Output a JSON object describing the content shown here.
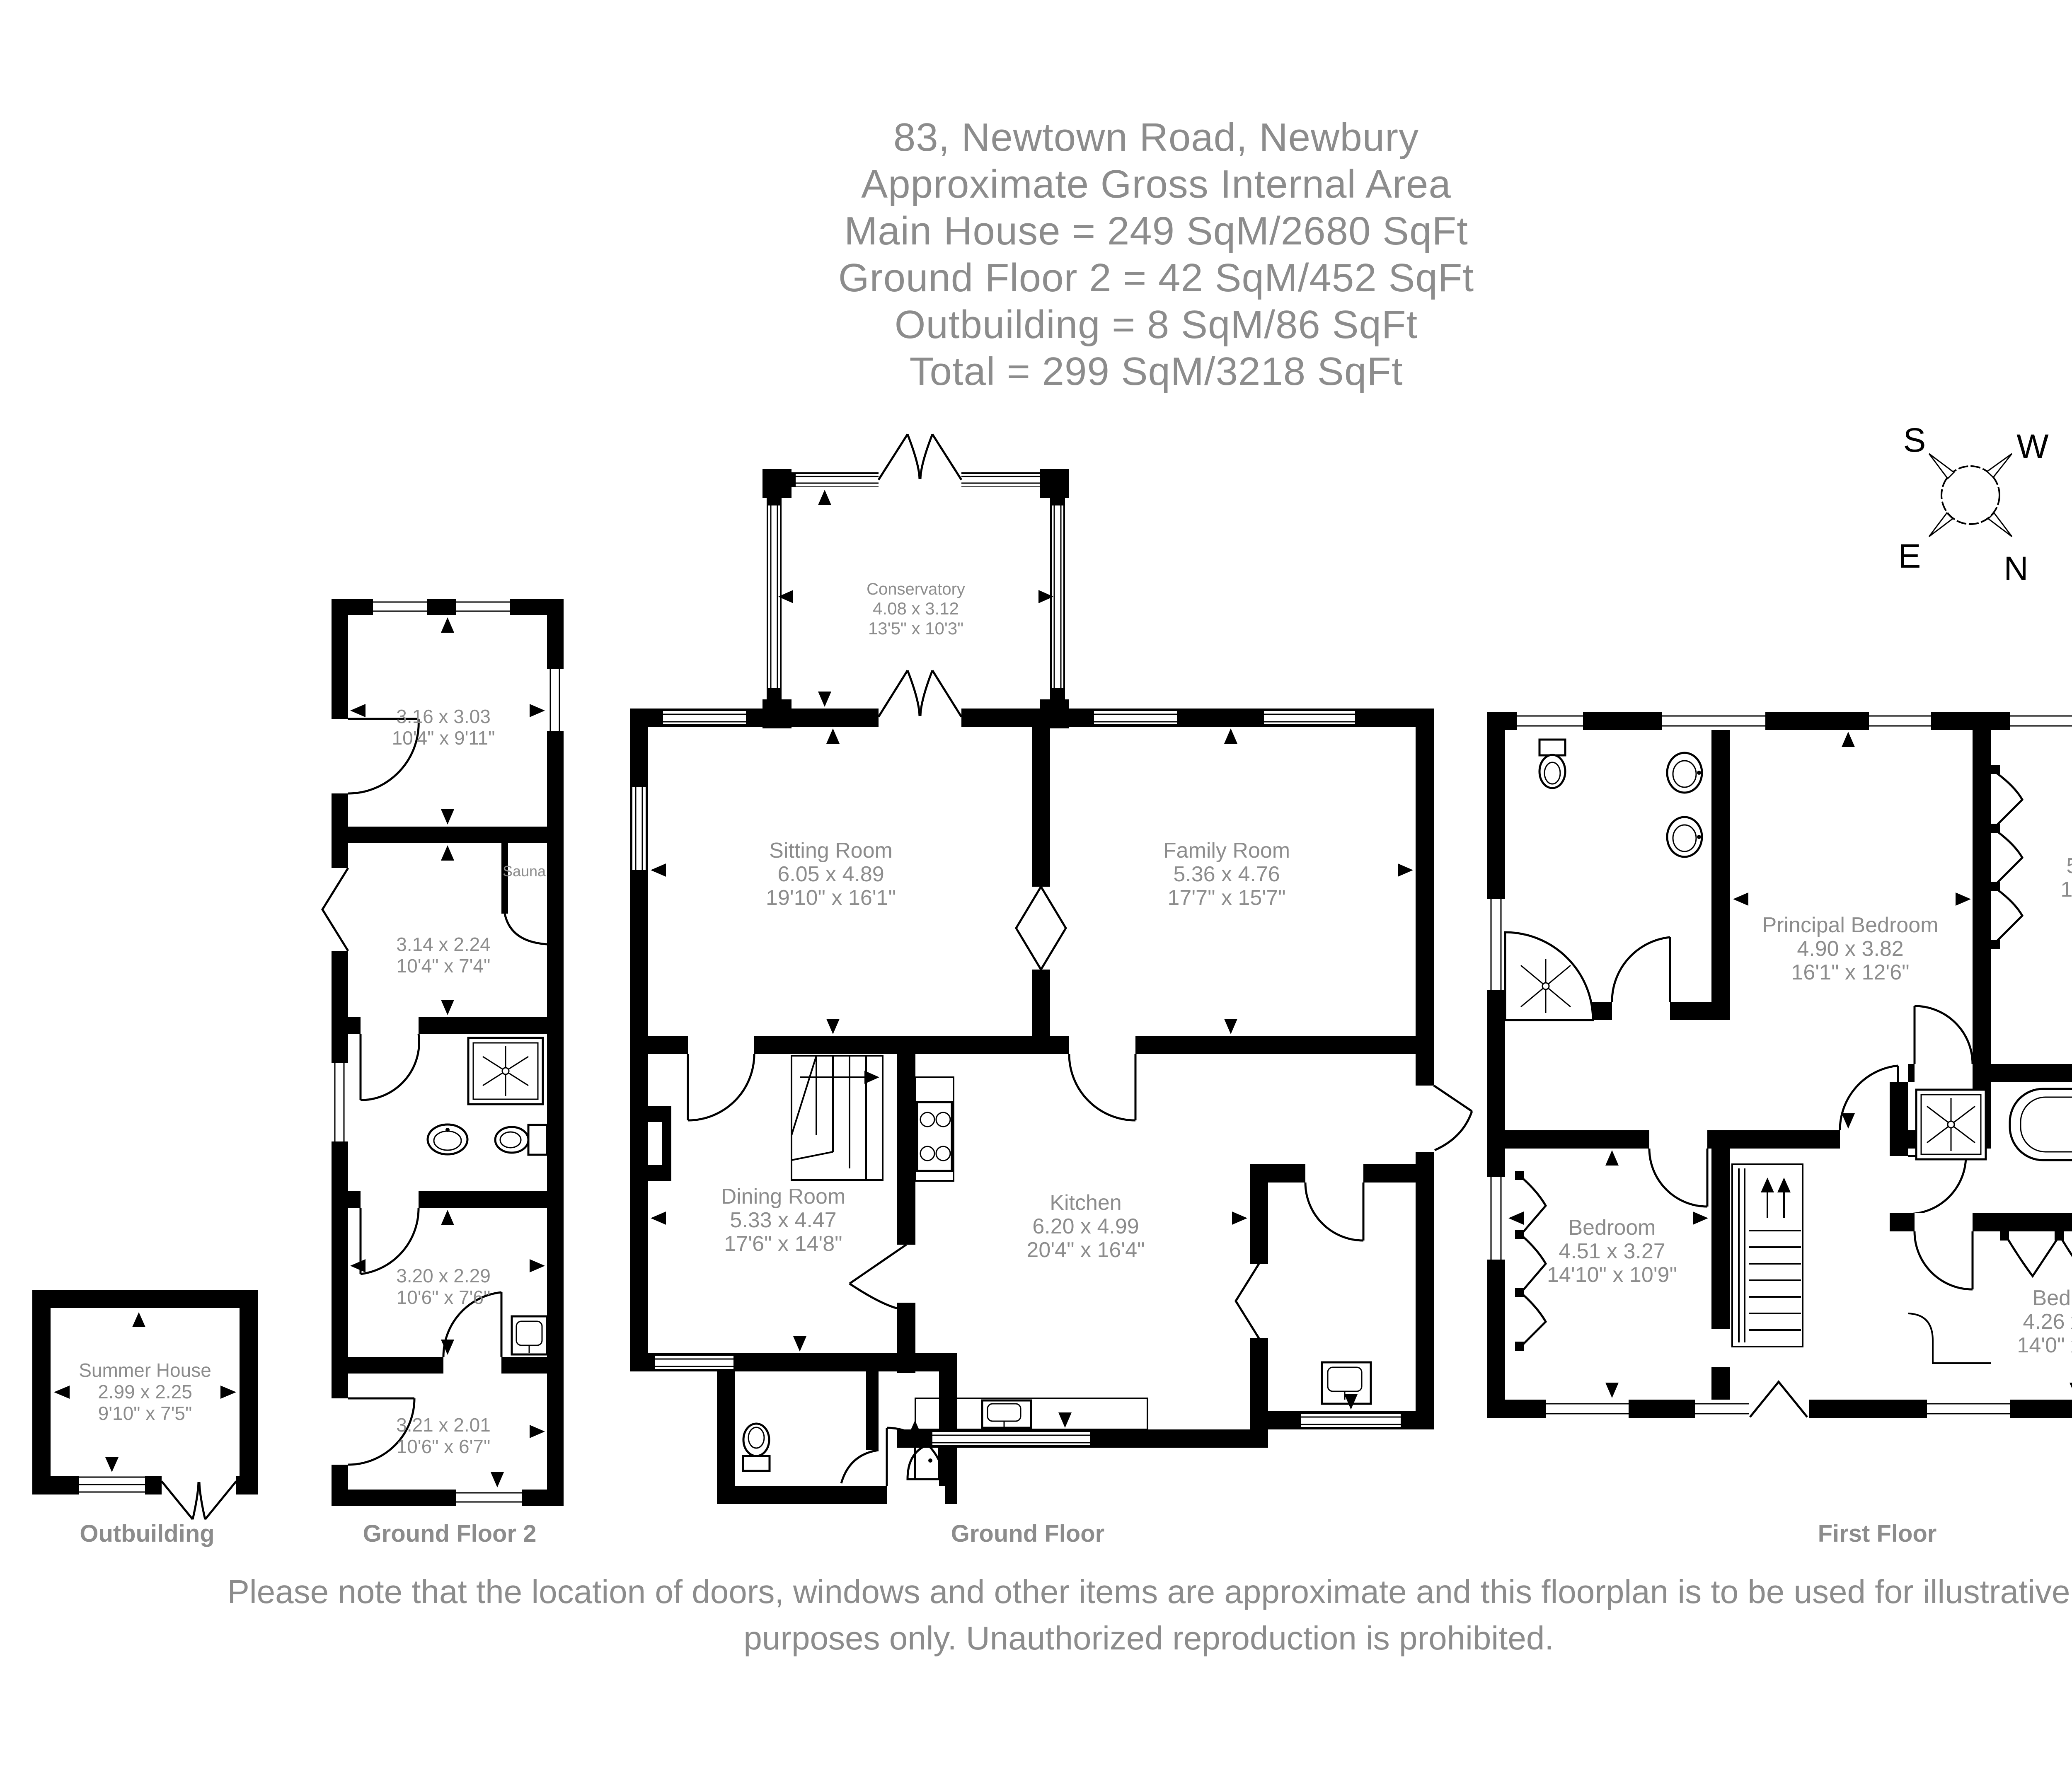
{
  "header": {
    "lines": [
      "83, Newtown Road, Newbury",
      "Approximate Gross Internal Area",
      "Main House = 249 SqM/2680 SqFt",
      "Ground Floor 2 = 42 SqM/452 SqFt",
      "Outbuilding = 8 SqM/86 SqFt",
      "Total = 299 SqM/3218 SqFt"
    ]
  },
  "compass": {
    "south": "S",
    "west": "W",
    "east": "E",
    "north": "N"
  },
  "outbuilding": {
    "floor_label": "Outbuilding",
    "summer_house": {
      "name": "Summer House",
      "metric": "2.99 x 2.25",
      "imperial": "9'10\" x 7'5\""
    }
  },
  "ground_floor_2": {
    "floor_label": "Ground Floor 2",
    "room_1": {
      "metric": "3.16 x 3.03",
      "imperial": "10'4\" x 9'11\""
    },
    "room_2": {
      "metric": "3.14 x 2.24",
      "imperial": "10'4\" x 7'4\""
    },
    "sauna": {
      "name": "Sauna"
    },
    "room_3": {
      "metric": "3.20 x 2.29",
      "imperial": "10'6\" x 7'6\""
    },
    "room_4": {
      "metric": "3.21 x 2.01",
      "imperial": "10'6\" x 6'7\""
    }
  },
  "ground_floor": {
    "floor_label": "Ground Floor",
    "conservatory": {
      "name": "Conservatory",
      "metric": "4.08 x 3.12",
      "imperial": "13'5\" x 10'3\""
    },
    "sitting_room": {
      "name": "Sitting Room",
      "metric": "6.05 x 4.89",
      "imperial": "19'10\" x 16'1\""
    },
    "family_room": {
      "name": "Family Room",
      "metric": "5.36 x 4.76",
      "imperial": "17'7\" x 15'7\""
    },
    "dining_room": {
      "name": "Dining Room",
      "metric": "5.33 x 4.47",
      "imperial": "17'6\" x 14'8\""
    },
    "kitchen": {
      "name": "Kitchen",
      "metric": "6.20 x 4.99",
      "imperial": "20'4\" x 16'4\""
    }
  },
  "first_floor": {
    "floor_label": "First Floor",
    "principal_bedroom": {
      "name": "Principal Bedroom",
      "metric": "4.90 x 3.82",
      "imperial": "16'1\" x 12'6\""
    },
    "bedroom_right": {
      "name": "Bedroom",
      "metric": "5.34 x 4.73",
      "imperial": "17'6\" x 15'6\""
    },
    "bedroom_left": {
      "name": "Bedroom",
      "metric": "4.51 x 3.27",
      "imperial": "14'10\" x 10'9\""
    },
    "bedroom_bottom": {
      "name": "Bedroom",
      "metric": "4.26 x 3.18",
      "imperial": "14'0\" x 10'5\""
    }
  },
  "disclaimer": {
    "line1": "Please note that the location of doors, windows and other items are approximate and this floorplan is to be used for illustrative",
    "line2": "purposes only. Unauthorized reproduction is prohibited."
  }
}
